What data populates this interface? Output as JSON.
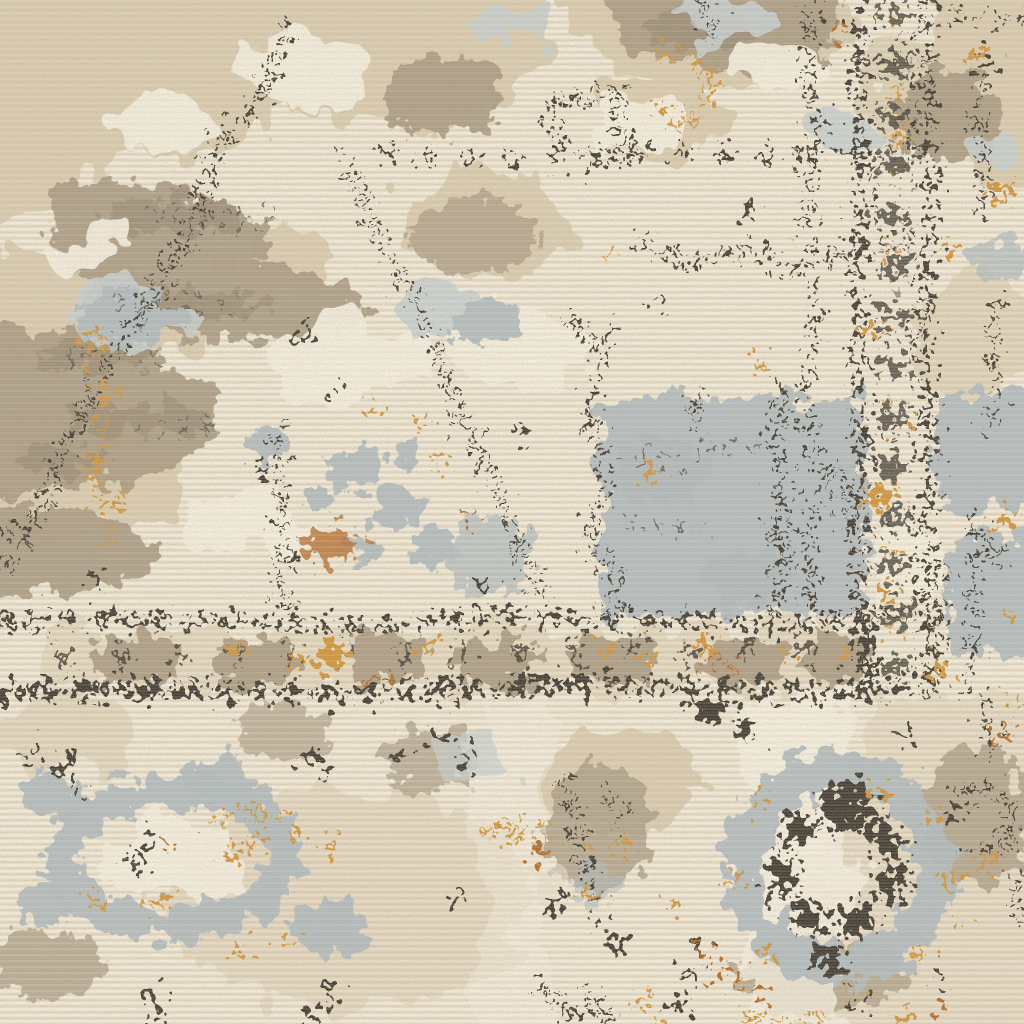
{
  "meta": {
    "type": "photograph",
    "subject": "Close-up macro photo of a distressed vintage-style area rug",
    "description": "Cream and ivory wool pile with horizontal weave striations; large taupe and tan eroded medallion masses in the upper left; a slate gray-blue stepped medallion block right of center; speckled dark-charcoal ornament outlines; a vertical chain-guard border band on the right side; a horizontal double speckled border band across the lower middle; a round slate and charcoal rosette in the lower right; small amber, gold and rust accents scattered throughout."
  },
  "palette": {
    "cream": "#ece4d1",
    "cream_light": "#f6f0e0",
    "tan_light": "#d7c8aa",
    "taupe": "#a6967e",
    "taupe_dark": "#8b7d68",
    "slate": "#aeb9bd",
    "slate_light": "#c6cecf",
    "charcoal": "#38332a",
    "charcoal_soft": "#5c5346",
    "amber": "#d09130",
    "amber_deep": "#b2641e",
    "weave_light": "#fff7e7",
    "weave_dark": "#d6c5a8"
  },
  "motifs": [
    "taupe eroded medallion mass upper-left",
    "charcoal stepped zigzag medallion edge",
    "slate stepped medallion block center-right",
    "vertical charcoal chain border band on right",
    "vertical guard stripe left of chain band",
    "horizontal double speckled border band",
    "taupe block ornaments inside horizontal band",
    "slate and charcoal rosette lower-right",
    "slate wreath motif lower-left",
    "amber chain accent left side",
    "gold dot accents around rosette",
    "scattered charcoal speckle dots",
    "cream pile with horizontal weave striations"
  ]
}
